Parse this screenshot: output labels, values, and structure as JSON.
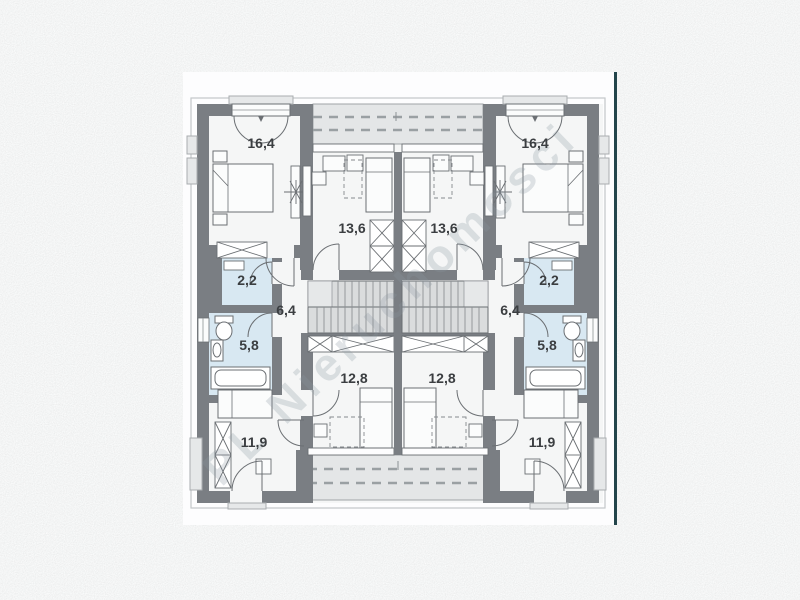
{
  "watermark": {
    "text": "PL Nieruchomosci"
  },
  "floorplan": {
    "type": "duplex-floor-plan",
    "rooms": [
      {
        "name": "bedroom-top-left",
        "area": "16,4"
      },
      {
        "name": "bedroom-top-right",
        "area": "16,4"
      },
      {
        "name": "room-upper-left",
        "area": "13,6"
      },
      {
        "name": "room-upper-right",
        "area": "13,6"
      },
      {
        "name": "closet-left",
        "area": "2,2"
      },
      {
        "name": "closet-right",
        "area": "2,2"
      },
      {
        "name": "hall-left",
        "area": "6,4"
      },
      {
        "name": "hall-right",
        "area": "6,4"
      },
      {
        "name": "bathroom-left",
        "area": "5,8"
      },
      {
        "name": "bathroom-right",
        "area": "5,8"
      },
      {
        "name": "room-lower-left",
        "area": "12,8"
      },
      {
        "name": "room-lower-right",
        "area": "12,8"
      },
      {
        "name": "bedroom-bottom-left",
        "area": "11,9"
      },
      {
        "name": "bedroom-bottom-right",
        "area": "11,9"
      }
    ]
  },
  "colors": {
    "background_noise": "#ebecec",
    "page": "#fdfdfe",
    "page_edge": "#23454b",
    "wall": "#7a7e83",
    "room_fill": "#f5f6f6",
    "wet_room_fill": "#d8e8f2",
    "terrace_band": "#e4e6e7",
    "stair_fill": "#dadcdd",
    "label_text": "#3b3e41",
    "watermark_text": "#8a97a1"
  }
}
